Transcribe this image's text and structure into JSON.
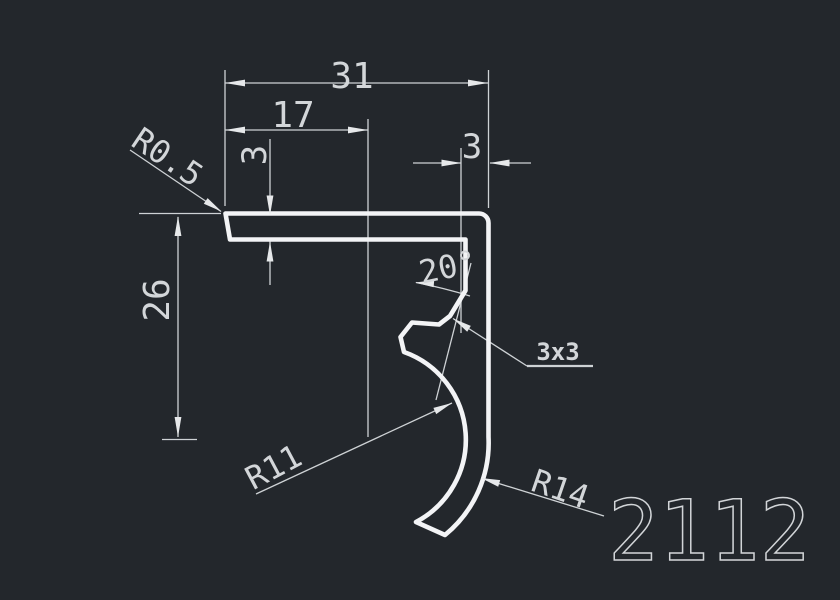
{
  "canvas": {
    "background_color": "#23272c",
    "geometry_color": "#f3f4f6",
    "dimension_color": "#ced2d5"
  },
  "drawing": {
    "part_label": "2112",
    "dimensions": {
      "width_total": "31",
      "width_partial": "17",
      "thickness_top": "3",
      "thickness_right": "3",
      "height": "26",
      "angle": "20°",
      "notch": "3x3",
      "radius_corner": "R0.5",
      "radius_inner": "R11",
      "radius_outer": "R14"
    }
  }
}
